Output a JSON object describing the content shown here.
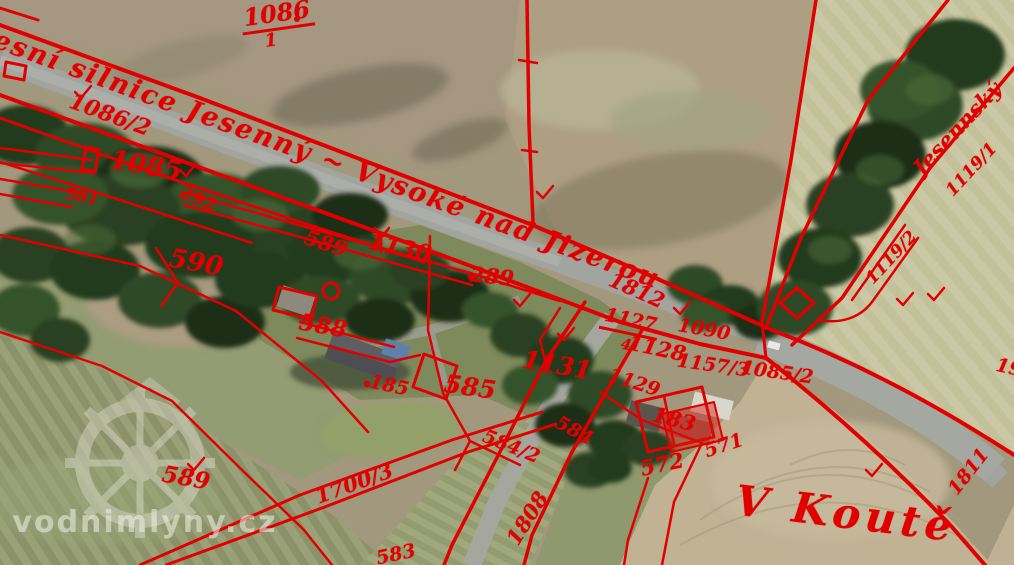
{
  "map_type": "cadastral-overlay-orthophoto",
  "overlay_color": "#e10000",
  "watermark": {
    "text": "vodnimlyny.cz"
  },
  "road_name": "okresní silnice Jesenný ~ Vysoké nad Jizerou",
  "area_name": "V Koutě",
  "stream_name": "Jesennský",
  "labels": [
    {
      "t": "okresní silnice Jesenný ~ Vysoké nad Jizerou",
      "x": 300,
      "y": 150,
      "r": 20,
      "s": 27,
      "c": "road",
      "n": "road-name-label"
    },
    {
      "t": "1086",
      "x": 277,
      "y": 16,
      "r": -8,
      "s": 24,
      "c": "frac",
      "n": "parcel-label"
    },
    {
      "t": "1",
      "x": 271,
      "y": 41,
      "r": -8,
      "s": 18,
      "n": "parcel-label"
    },
    {
      "t": "1086/2",
      "x": 110,
      "y": 115,
      "r": 20,
      "s": 22,
      "n": "parcel-label"
    },
    {
      "t": "1085",
      "x": 146,
      "y": 166,
      "r": 10,
      "s": 26,
      "n": "parcel-label"
    },
    {
      "t": "581",
      "x": 82,
      "y": 197,
      "r": 12,
      "s": 16,
      "n": "parcel-label"
    },
    {
      "t": "292",
      "x": 198,
      "y": 200,
      "r": 24,
      "s": 18,
      "n": "parcel-label"
    },
    {
      "t": "590",
      "x": 196,
      "y": 263,
      "r": 10,
      "s": 26,
      "n": "parcel-label"
    },
    {
      "t": "589",
      "x": 326,
      "y": 243,
      "r": 18,
      "s": 21,
      "n": "parcel-label"
    },
    {
      "t": "1130",
      "x": 400,
      "y": 248,
      "r": 12,
      "s": 23,
      "n": "parcel-label"
    },
    {
      "t": "289",
      "x": 492,
      "y": 276,
      "r": 6,
      "s": 21,
      "n": "parcel-label"
    },
    {
      "t": "588",
      "x": 323,
      "y": 326,
      "r": 10,
      "s": 23,
      "n": "parcel-label"
    },
    {
      "t": "185",
      "x": 389,
      "y": 386,
      "r": 12,
      "s": 19,
      "n": "parcel-label"
    },
    {
      "t": "585",
      "x": 470,
      "y": 387,
      "r": 8,
      "s": 25,
      "n": "parcel-label"
    },
    {
      "t": "1131",
      "x": 557,
      "y": 365,
      "r": 10,
      "s": 25,
      "n": "parcel-label"
    },
    {
      "t": "1812",
      "x": 637,
      "y": 290,
      "r": 24,
      "s": 21,
      "n": "parcel-label"
    },
    {
      "t": "1127",
      "x": 630,
      "y": 323,
      "r": 12,
      "s": 19,
      "c": "frac",
      "n": "parcel-label"
    },
    {
      "t": "4",
      "x": 626,
      "y": 345,
      "r": 12,
      "s": 15,
      "n": "parcel-label"
    },
    {
      "t": "1128",
      "x": 657,
      "y": 348,
      "r": 12,
      "s": 21,
      "n": "parcel-label"
    },
    {
      "t": "1090",
      "x": 704,
      "y": 330,
      "r": 10,
      "s": 19,
      "n": "parcel-label"
    },
    {
      "t": "1129",
      "x": 634,
      "y": 383,
      "r": 18,
      "s": 19,
      "n": "parcel-label"
    },
    {
      "t": "1157/3",
      "x": 713,
      "y": 366,
      "r": 8,
      "s": 19,
      "n": "parcel-label"
    },
    {
      "t": "1085/2",
      "x": 777,
      "y": 373,
      "r": 8,
      "s": 19,
      "n": "parcel-label"
    },
    {
      "t": "183",
      "x": 674,
      "y": 419,
      "r": 14,
      "s": 21,
      "n": "parcel-label"
    },
    {
      "t": "571",
      "x": 724,
      "y": 446,
      "r": -18,
      "s": 19,
      "n": "parcel-label"
    },
    {
      "t": "572",
      "x": 662,
      "y": 464,
      "r": -12,
      "s": 21,
      "n": "parcel-label"
    },
    {
      "t": "584",
      "x": 574,
      "y": 431,
      "r": 28,
      "s": 19,
      "n": "parcel-label"
    },
    {
      "t": "584/2",
      "x": 511,
      "y": 447,
      "r": 22,
      "s": 19,
      "n": "parcel-label"
    },
    {
      "t": "1700/3",
      "x": 354,
      "y": 483,
      "r": -20,
      "s": 21,
      "n": "parcel-label"
    },
    {
      "t": "589",
      "x": 186,
      "y": 478,
      "r": 10,
      "s": 23,
      "n": "parcel-label"
    },
    {
      "t": "1808",
      "x": 527,
      "y": 518,
      "r": -58,
      "s": 21,
      "n": "parcel-label"
    },
    {
      "t": "583",
      "x": 396,
      "y": 555,
      "r": -12,
      "s": 19,
      "n": "parcel-label"
    },
    {
      "t": "V Koutě",
      "x": 846,
      "y": 514,
      "r": 7,
      "s": 42,
      "c": "big",
      "n": "area-name-label"
    },
    {
      "t": "1811",
      "x": 969,
      "y": 472,
      "r": -52,
      "s": 19,
      "n": "parcel-label"
    },
    {
      "t": "Jesennský",
      "x": 957,
      "y": 128,
      "r": -47,
      "s": 21,
      "n": "stream-name-label"
    },
    {
      "t": "1119/1",
      "x": 972,
      "y": 170,
      "r": -47,
      "s": 17,
      "n": "parcel-label"
    },
    {
      "t": "1119/2",
      "x": 892,
      "y": 258,
      "r": -47,
      "s": 17,
      "n": "parcel-label"
    },
    {
      "t": "19",
      "x": 1009,
      "y": 368,
      "r": 12,
      "s": 19,
      "n": "parcel-label"
    },
    {
      "t": "vodnimlyny.cz",
      "x": 145,
      "y": 523,
      "r": 0,
      "s": 30,
      "c": "wm",
      "n": "watermark-text"
    }
  ]
}
